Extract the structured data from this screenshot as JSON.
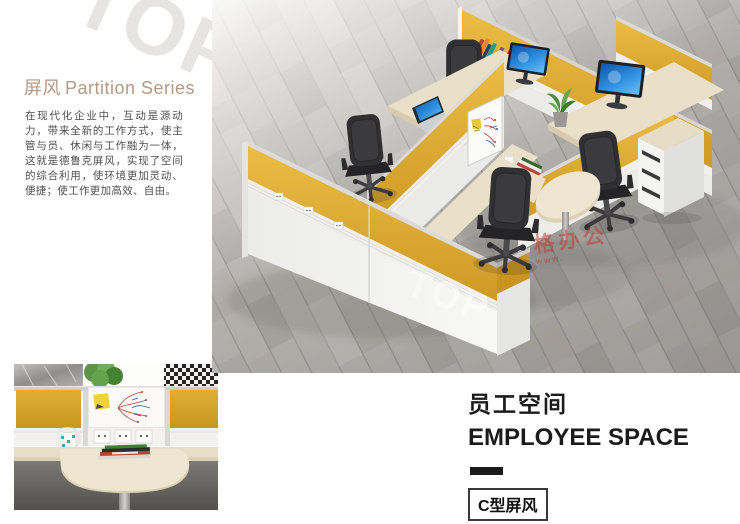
{
  "intro": {
    "title_cn": "屏风",
    "title_en": "Partition Series",
    "paragraph": "在现代化企业中，互动是源动力，带来全新的工作方式，使主管与员、休闲与工作融为一体，这就是德鲁克屏风，实现了空间的综合利用，使环境更加灵动、便捷；使工作更加高效、自由。"
  },
  "caption": {
    "title_cn": "员工空间",
    "title_en": "EMPLOYEE SPACE",
    "model_label": "C型屏风"
  },
  "watermarks": {
    "brand_logo": "TOP",
    "photo_logo": "TOP",
    "red_stamp": "格办公",
    "red_stamp_sub": "www."
  },
  "colors": {
    "partition_yellow": "#D9A62E",
    "title_tan": "#B29A84",
    "body_text": "#4F4F4F",
    "heading_black": "#1B1B1B",
    "floor_gray": "#B5B1AD",
    "desk_wood": "#EADFC8"
  }
}
